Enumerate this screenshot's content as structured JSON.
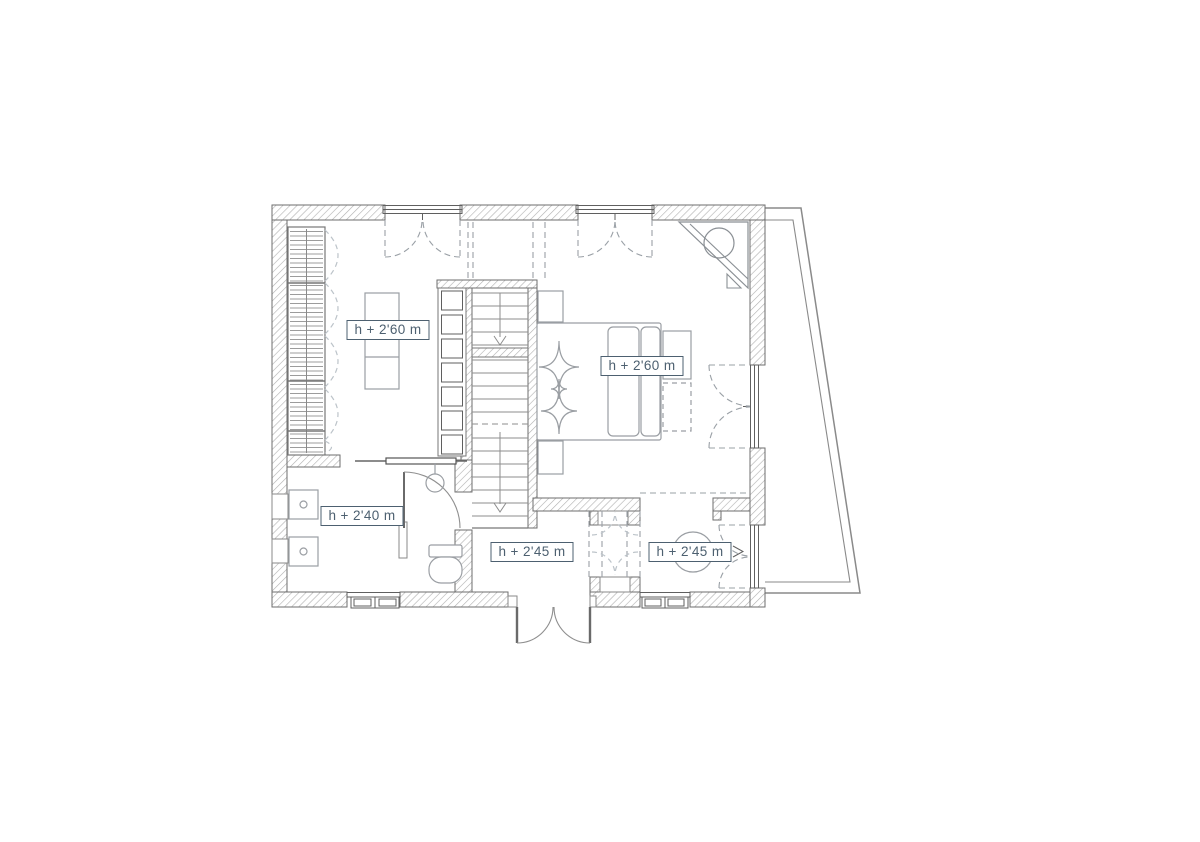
{
  "floor_plan": {
    "rooms": [
      {
        "name": "dressing-room",
        "height_label": "h + 2'60 m"
      },
      {
        "name": "bedroom",
        "height_label": "h + 2'60 m"
      },
      {
        "name": "bathroom",
        "height_label": "h + 2'40 m"
      },
      {
        "name": "entrance-hall",
        "height_label": "h + 2'45 m"
      },
      {
        "name": "sitting-room",
        "height_label": "h + 2'45 m"
      }
    ],
    "colors": {
      "label": "#4d6070",
      "walls": "#6e6e6e",
      "hatch": "#b0b0b0",
      "furniture": "#9a9ea3",
      "dashed": "#9aa0a6",
      "light_dashed": "#bcc3c9",
      "background": "#ffffff"
    }
  }
}
